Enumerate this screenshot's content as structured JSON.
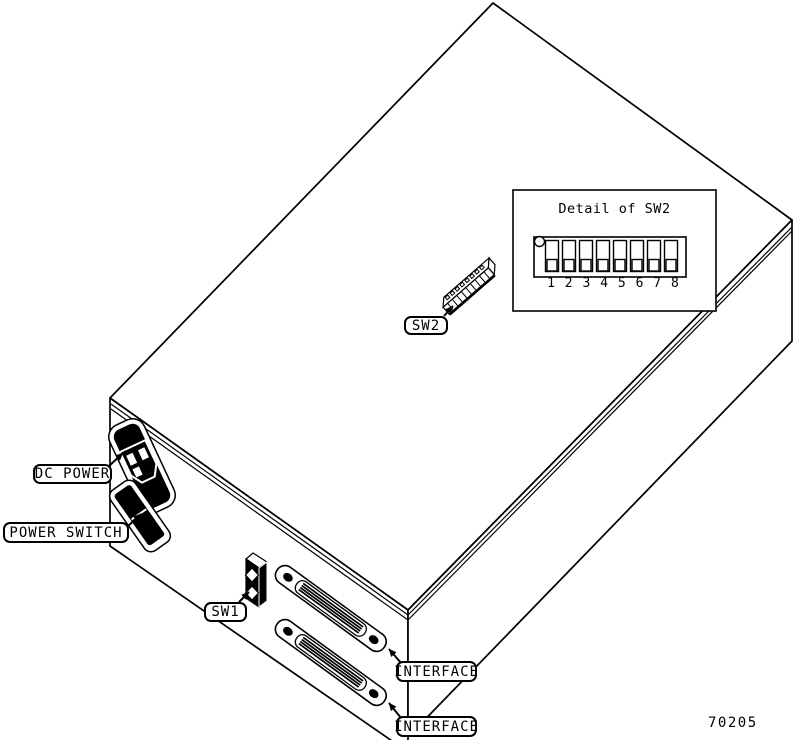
{
  "diagram": {
    "figure_number": "70205",
    "colors": {
      "ink": "#000000",
      "paper": "#ffffff"
    },
    "labels": {
      "dc_power": "DC POWER",
      "power_switch": "POWER SWITCH",
      "sw1": "SW1",
      "sw2": "SW2",
      "interface_upper": "INTERFACE",
      "interface_lower": "INTERFACE"
    },
    "detail": {
      "title": "Detail of SW2",
      "numbers": [
        "1",
        "2",
        "3",
        "4",
        "5",
        "6",
        "7",
        "8"
      ]
    }
  }
}
